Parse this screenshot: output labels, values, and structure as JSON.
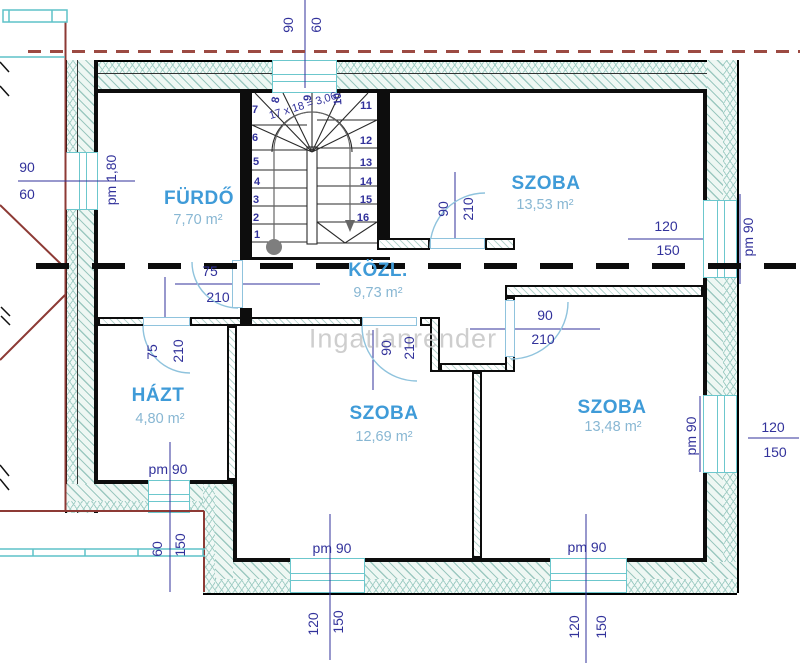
{
  "watermark": "Ingatlanrender",
  "rooms": {
    "furdo": {
      "name": "FÜRDŐ",
      "area": "7,70 m²"
    },
    "szoba1": {
      "name": "SZOBA",
      "area": "13,53 m²"
    },
    "kozl": {
      "name": "KÖZL.",
      "area": "9,73 m²"
    },
    "hazt": {
      "name": "HÁZT",
      "area": "4,80 m²"
    },
    "szoba2": {
      "name": "SZOBA",
      "area": "12,69 m²"
    },
    "szoba3": {
      "name": "SZOBA",
      "area": "13,48 m²"
    }
  },
  "stair": {
    "formula": "17 x 18 = 3,06",
    "numbers": [
      "1",
      "2",
      "3",
      "4",
      "5",
      "6",
      "7",
      "8",
      "9",
      "10",
      "11",
      "12",
      "13",
      "14",
      "15",
      "16"
    ]
  },
  "dims": {
    "top_window": {
      "w": "90",
      "g": "60"
    },
    "left_window": {
      "w": "90",
      "g": "60",
      "sill": "pm 1,80"
    },
    "bath_door": {
      "w": "75",
      "h": "210"
    },
    "hazt_door": {
      "w": "75",
      "h": "210"
    },
    "szoba1_door": {
      "w": "90",
      "h": "210"
    },
    "szoba2_door": {
      "w": "90",
      "h": "210"
    },
    "szoba3_door": {
      "w": "90",
      "h": "210"
    },
    "right_window1": {
      "w": "120",
      "h": "150",
      "sill": "pm 90"
    },
    "right_window2": {
      "w": "120",
      "h": "150",
      "sill": "pm 90"
    },
    "bottom_window1": {
      "w": "120",
      "h": "150",
      "sill": "pm 90"
    },
    "bottom_window2": {
      "w": "120",
      "h": "150",
      "sill": "pm 90"
    },
    "hazt_window": {
      "w": "60",
      "h": "150",
      "sill": "pm 90"
    }
  },
  "colors": {
    "room_label": "#3f9bd8",
    "area_label": "#88b7d3",
    "dimension": "#32329b",
    "wall": "#0d0d0d",
    "hatch": "#a4cfc7",
    "window": "#6cc7cd",
    "red_outline": "#8d3a35",
    "watermark": "#c3c3c3"
  }
}
